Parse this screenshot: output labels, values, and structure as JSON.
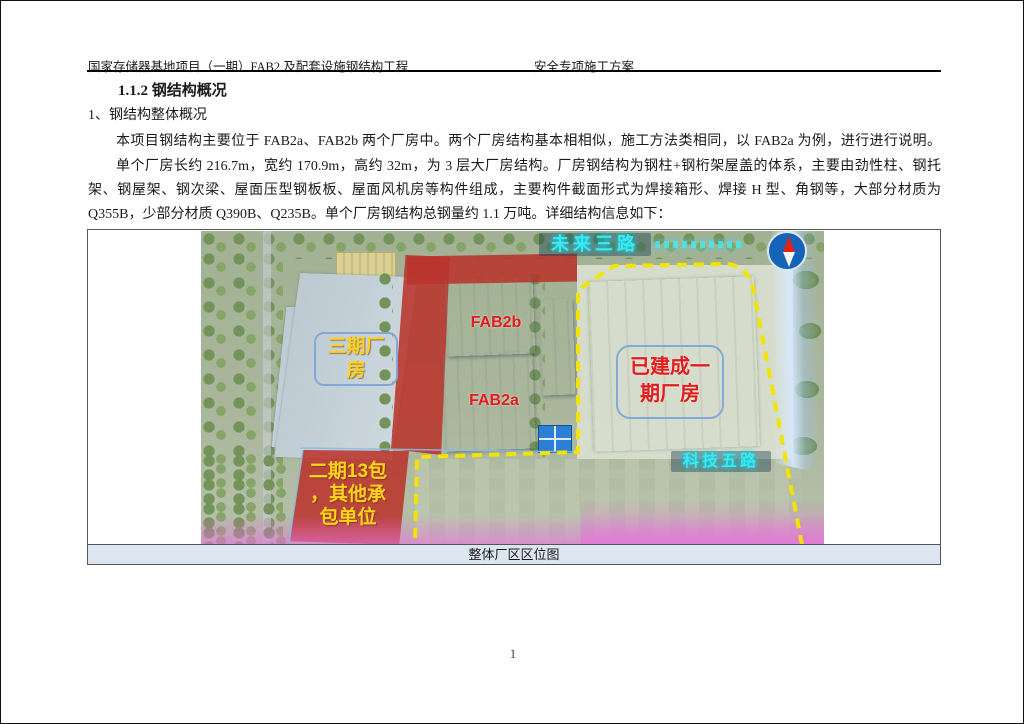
{
  "header": {
    "left": "国家存储器基地项目（一期）FAB2 及配套设施钢结构工程",
    "right": "安全专项施工方案"
  },
  "heading": "1.1.2 钢结构概况",
  "body": {
    "line1": "1、钢结构整体概况",
    "para1": "本项目钢结构主要位于 FAB2a、FAB2b 两个厂房中。两个厂房结构基本相相似，施工方法类相同，以 FAB2a 为例，进行进行说明。",
    "para2_lines": [
      "单个厂房长约 216.7m，宽约 170.9m，高约 32m，为 3 层大厂房结构。厂房钢结构为钢柱+钢桁架屋盖的体系，主要由劲性柱、钢托",
      "架、钢屋架、钢次梁、屋面压型钢板板、屋面风机房等构件组成，主要构件截面形式为焊接箱形、焊接 H 型、角钢等，大部分材质为",
      "Q355B，少部分材质 Q390B、Q235B。单个厂房钢结构总钢量约 1.1 万吨。详细结构信息如下："
    ]
  },
  "figure": {
    "caption": "整体厂区区位图",
    "map": {
      "road_top": "未来三路",
      "road_right": "科技五路",
      "fab2b": "FAB2b",
      "fab2a": "FAB2a",
      "phase3_lines": [
        "三期厂",
        "房"
      ],
      "built_lines": [
        "已建成一",
        "期厂房"
      ],
      "phase2_lines": [
        "二期13包",
        "，其他承",
        "包单位"
      ],
      "icons": [
        "compass-icon"
      ],
      "colors": {
        "highlight_red": "#ba342c",
        "label_yellow": "#ffd31c",
        "label_red": "#e31b1b",
        "boundary_yellow": "#f2e205",
        "road_glow_cyan": "#3fe7ef",
        "caption_bg": "#dce6f1"
      }
    }
  },
  "page_number": "1"
}
